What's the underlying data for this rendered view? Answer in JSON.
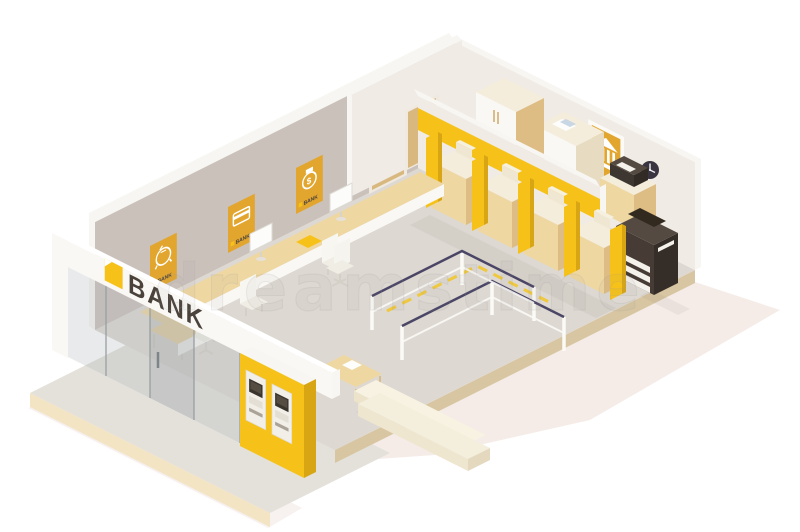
{
  "scene": {
    "type": "isometric-illustration",
    "subject": "Low poly bank office interior cutaway",
    "background": "#ffffff"
  },
  "sign": {
    "label": "BANK"
  },
  "posters": {
    "left_wall": [
      {
        "icon": "piggy-bank-icon",
        "label": "BANK"
      },
      {
        "icon": "credit-card-icon",
        "label": "BANK"
      },
      {
        "icon": "money-bag-icon",
        "label": "BANK"
      }
    ],
    "right_wall": [
      {
        "icon": "bank-building-icon",
        "label": "BANK"
      }
    ]
  },
  "watermark": {
    "text": "dreamstime"
  },
  "counts": {
    "atm_machines": 2,
    "teller_stations": 4,
    "teller_dividers": 5,
    "queue_posts": 6,
    "left_wall_posters": 3,
    "doors": 2,
    "monitors": 2
  },
  "colors": {
    "accent_yellow": "#F6C21A",
    "accent_yellow_dark": "#D8A515",
    "poster_orange": "#E2A62F",
    "wall": "#CBC1BB",
    "wall_light": "#F0EBE5",
    "wall_top": "#F8F6F2",
    "floor": "#DDD8D1",
    "floor_edge": "#D8C6A2",
    "sidewalk": "#E4E1DB",
    "sidewalk_edge": "#F3E4C4",
    "wood": "#EFD7A2",
    "wood_dark": "#DEBD84",
    "cream": "#F4EDDC",
    "cream_dark": "#E7DCC2",
    "white_warm": "#FAF8F4",
    "door_tan": "#D8B87E",
    "dark_wood": "#473D35",
    "dark_screen": "#3A342E",
    "belt": "#4B4566",
    "glass": "#ADB4B8",
    "shadow": "#ECDCD6",
    "dash_yellow": "#EFC83D",
    "text_dark": "#4A423B"
  }
}
